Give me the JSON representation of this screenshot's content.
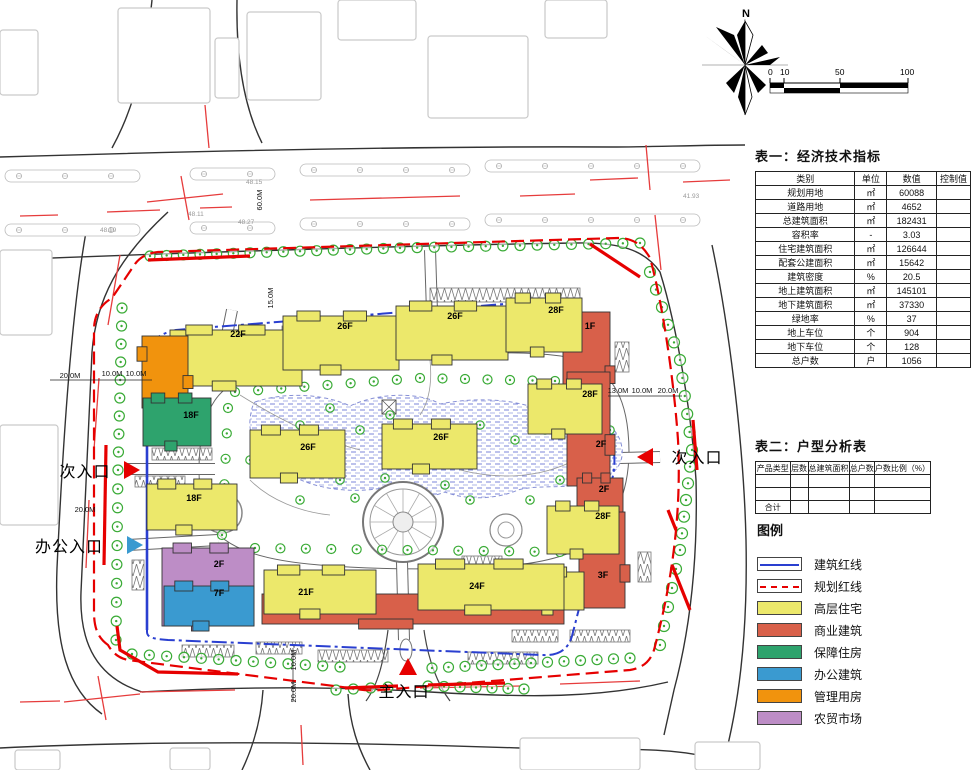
{
  "compass": {
    "label": "N"
  },
  "scale_bar": {
    "ticks": [
      "0",
      "10",
      "50",
      "100"
    ]
  },
  "table1": {
    "title": "表一：经济技术指标",
    "headers": [
      "类别",
      "单位",
      "数值",
      "控制值"
    ],
    "rows": [
      [
        "规划用地",
        "㎡",
        "60088",
        ""
      ],
      [
        "道路用地",
        "㎡",
        "4652",
        ""
      ],
      [
        "总建筑面积",
        "㎡",
        "182431",
        ""
      ],
      [
        "容积率",
        "-",
        "3.03",
        ""
      ],
      [
        "住宅建筑面积",
        "㎡",
        "126644",
        ""
      ],
      [
        "配套公建面积",
        "㎡",
        "15642",
        ""
      ],
      [
        "建筑密度",
        "%",
        "20.5",
        ""
      ],
      [
        "地上建筑面积",
        "㎡",
        "145101",
        ""
      ],
      [
        "地下建筑面积",
        "㎡",
        "37330",
        ""
      ],
      [
        "绿地率",
        "%",
        "37",
        ""
      ],
      [
        "地上车位",
        "个",
        "904",
        ""
      ],
      [
        "地下车位",
        "个",
        "128",
        ""
      ],
      [
        "总户数",
        "户",
        "1056",
        ""
      ]
    ]
  },
  "table2": {
    "title": "表二：户型分析表",
    "headers": [
      "产品类型",
      "层数",
      "总建筑面积",
      "总户数",
      "户数比例（%）"
    ],
    "rows": [
      [
        "",
        "",
        "",
        "",
        ""
      ],
      [
        "",
        "",
        "",
        "",
        ""
      ],
      [
        "合计",
        "",
        "",
        "",
        ""
      ]
    ]
  },
  "legend": {
    "title": "图例",
    "items": [
      {
        "label": "建筑红线",
        "type": "line-blue"
      },
      {
        "label": "规划红线",
        "type": "line-red"
      },
      {
        "label": "高层住宅",
        "type": "swatch",
        "color": "#ece86b"
      },
      {
        "label": "商业建筑",
        "type": "swatch",
        "color": "#d8604a"
      },
      {
        "label": "保障住房",
        "type": "swatch",
        "color": "#2ea36d"
      },
      {
        "label": "办公建筑",
        "type": "swatch",
        "color": "#3a9ad0"
      },
      {
        "label": "管理用房",
        "type": "swatch",
        "color": "#f1930d"
      },
      {
        "label": "农贸市场",
        "type": "swatch",
        "color": "#bd8dc6"
      }
    ]
  },
  "colors": {
    "residential": "#ece86b",
    "commercial": "#d8604a",
    "affordable": "#2ea36d",
    "office": "#3a9ad0",
    "management": "#f1930d",
    "market": "#bd8dc6",
    "building_line": "#2a3fd0",
    "planning_line": "#e60000",
    "tree": "#3aab36"
  },
  "entrances": [
    {
      "label": "次入口",
      "x": 85,
      "y": 477,
      "marker": "triangle-right",
      "mcolor": "#e60000",
      "mx": 124,
      "my": 470
    },
    {
      "label": "办公入口",
      "x": 69,
      "y": 552,
      "marker": "triangle-right",
      "mcolor": "#3a9ad0",
      "mx": 127,
      "my": 545
    },
    {
      "label": "次入口",
      "x": 697,
      "y": 463,
      "marker": "triangle-left",
      "mcolor": "#e60000",
      "mx": 653,
      "my": 457
    },
    {
      "label": "主入口",
      "x": 404,
      "y": 697,
      "marker": "triangle-up",
      "mcolor": "#e60000",
      "mx": 408,
      "my": 668
    }
  ],
  "plan": {
    "buildings": [
      {
        "t": "commercial",
        "label": "",
        "x": 262,
        "y": 594,
        "w": 302,
        "h": 30
      },
      {
        "t": "commercial",
        "label": "1F",
        "x": 563,
        "y": 312,
        "w": 47,
        "h": 98,
        "lx": 590,
        "ly": 329
      },
      {
        "t": "commercial",
        "label": "2F",
        "x": 567,
        "y": 372,
        "w": 43,
        "h": 114,
        "lx": 601,
        "ly": 447
      },
      {
        "t": "commercial",
        "label": "2F",
        "x": 577,
        "y": 478,
        "w": 46,
        "h": 40,
        "lx": 604,
        "ly": 492
      },
      {
        "t": "commercial",
        "label": "3F",
        "x": 579,
        "y": 512,
        "w": 46,
        "h": 96,
        "lx": 603,
        "ly": 578
      },
      {
        "t": "residential",
        "label": "22F",
        "x": 170,
        "y": 330,
        "w": 132,
        "h": 56,
        "lx": 238,
        "ly": 337
      },
      {
        "t": "residential",
        "label": "26F",
        "x": 283,
        "y": 316,
        "w": 116,
        "h": 54,
        "lx": 345,
        "ly": 329
      },
      {
        "t": "residential",
        "label": "26F",
        "x": 396,
        "y": 306,
        "w": 112,
        "h": 54,
        "lx": 455,
        "ly": 319
      },
      {
        "t": "residential",
        "label": "28F",
        "x": 506,
        "y": 298,
        "w": 76,
        "h": 54,
        "lx": 556,
        "ly": 313
      },
      {
        "t": "residential",
        "label": "28F",
        "x": 528,
        "y": 384,
        "w": 74,
        "h": 50,
        "lx": 590,
        "ly": 397
      },
      {
        "t": "residential",
        "label": "28F",
        "x": 547,
        "y": 506,
        "w": 72,
        "h": 48,
        "lx": 603,
        "ly": 519
      },
      {
        "t": "residential",
        "label": "21F",
        "x": 522,
        "y": 572,
        "w": 62,
        "h": 38,
        "lx": 542,
        "ly": 586
      },
      {
        "t": "residential",
        "label": "21F",
        "x": 264,
        "y": 570,
        "w": 112,
        "h": 44,
        "lx": 306,
        "ly": 595
      },
      {
        "t": "residential",
        "label": "24F",
        "x": 418,
        "y": 564,
        "w": 146,
        "h": 46,
        "lx": 477,
        "ly": 589
      },
      {
        "t": "residential",
        "label": "26F",
        "x": 250,
        "y": 430,
        "w": 95,
        "h": 48,
        "lx": 308,
        "ly": 450
      },
      {
        "t": "residential",
        "label": "26F",
        "x": 382,
        "y": 424,
        "w": 95,
        "h": 45,
        "lx": 441,
        "ly": 440
      },
      {
        "t": "management",
        "label": "",
        "x": 142,
        "y": 336,
        "w": 46,
        "h": 72
      },
      {
        "t": "affordable",
        "label": "18F",
        "x": 143,
        "y": 398,
        "w": 68,
        "h": 48,
        "lx": 191,
        "ly": 418
      },
      {
        "t": "residential",
        "label": "18F",
        "x": 147,
        "y": 484,
        "w": 90,
        "h": 46,
        "lx": 194,
        "ly": 501
      },
      {
        "t": "market",
        "label": "2F",
        "x": 162,
        "y": 548,
        "w": 92,
        "h": 78,
        "lx": 219,
        "ly": 567
      },
      {
        "t": "office",
        "label": "7F",
        "x": 164,
        "y": 586,
        "w": 90,
        "h": 40,
        "lx": 219,
        "ly": 596
      }
    ],
    "dimensions": [
      {
        "text": "20.0M",
        "x": 70,
        "y": 378,
        "rot": 0
      },
      {
        "text": "10.0M",
        "x": 112,
        "y": 376,
        "rot": 0
      },
      {
        "text": "10.0M",
        "x": 136,
        "y": 376,
        "rot": 0
      },
      {
        "text": "20.0M",
        "x": 85,
        "y": 512,
        "rot": 0
      },
      {
        "text": "13.0M",
        "x": 618,
        "y": 393,
        "rot": 0
      },
      {
        "text": "10.0M",
        "x": 642,
        "y": 393,
        "rot": 0
      },
      {
        "text": "20.0M",
        "x": 668,
        "y": 393,
        "rot": 0
      },
      {
        "text": "15.0M",
        "x": 273,
        "y": 298,
        "rot": -90
      },
      {
        "text": "60.0M",
        "x": 262,
        "y": 200,
        "rot": -90
      },
      {
        "text": "10.0M",
        "x": 296,
        "y": 660,
        "rot": -90
      },
      {
        "text": "20.0M",
        "x": 296,
        "y": 692,
        "rot": -90
      }
    ],
    "elevations": [
      {
        "text": "48.11",
        "x": 188,
        "y": 216
      },
      {
        "text": "48.15",
        "x": 246,
        "y": 184
      },
      {
        "text": "48.27",
        "x": 238,
        "y": 224
      },
      {
        "text": "48.19",
        "x": 100,
        "y": 232
      },
      {
        "text": "41.93",
        "x": 683,
        "y": 198
      }
    ]
  }
}
